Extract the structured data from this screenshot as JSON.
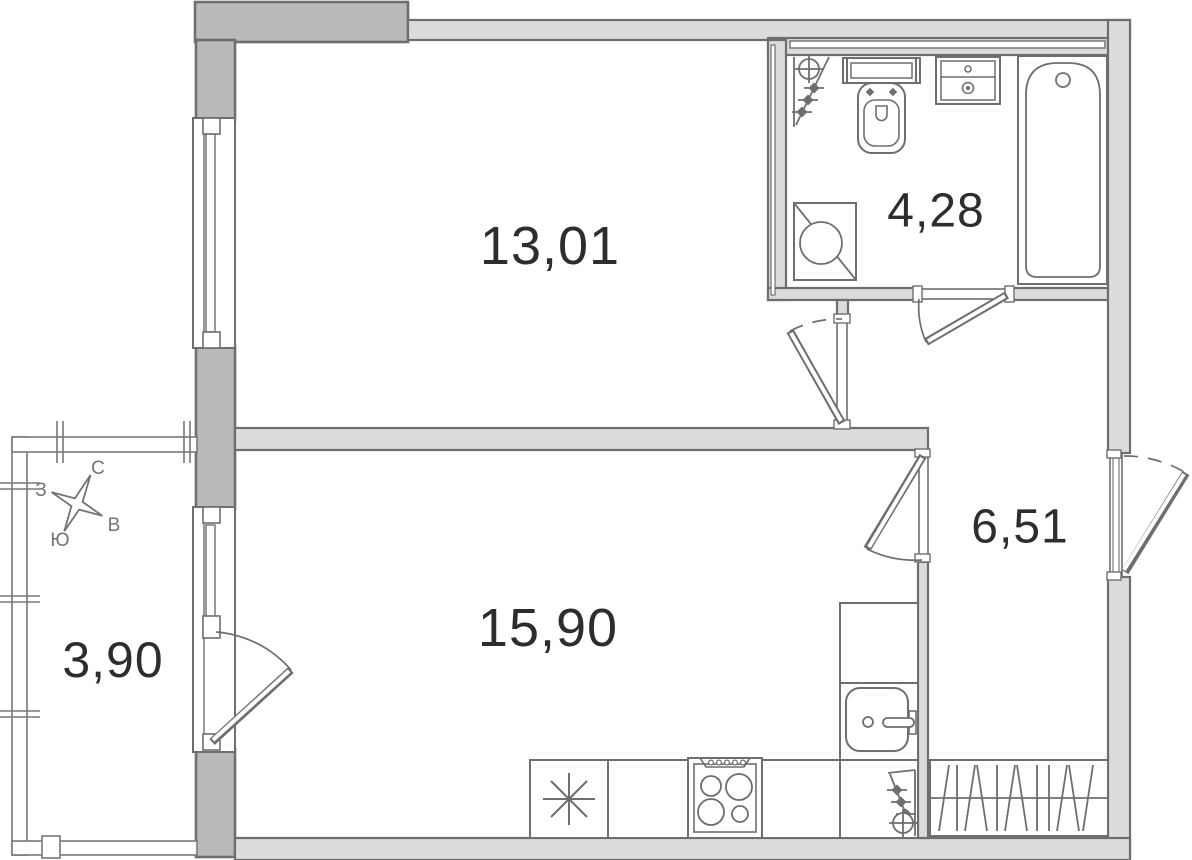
{
  "floor_plan": {
    "rooms": [
      {
        "name": "living-room",
        "area": "13,01"
      },
      {
        "name": "bathroom",
        "area": "4,28"
      },
      {
        "name": "hallway",
        "area": "6,51"
      },
      {
        "name": "kitchen-living-room",
        "area": "15,90"
      },
      {
        "name": "balcony",
        "area": "3,90"
      }
    ],
    "compass": {
      "north": "С",
      "east": "В",
      "south": "Ю",
      "west": "З"
    },
    "colors": {
      "wall_light_fill": "#dcdcdc",
      "wall_dark_fill": "#bababa",
      "line": "#6e6e6e",
      "label_text": "#2d2d2d",
      "background": "#ffffff"
    },
    "fixtures": [
      "heating-riser",
      "toilet",
      "washbasin-cabinet",
      "bathtub",
      "washing-machine",
      "refrigerator",
      "stove",
      "kitchen-sink",
      "kitchen-riser",
      "wardrobe"
    ]
  }
}
